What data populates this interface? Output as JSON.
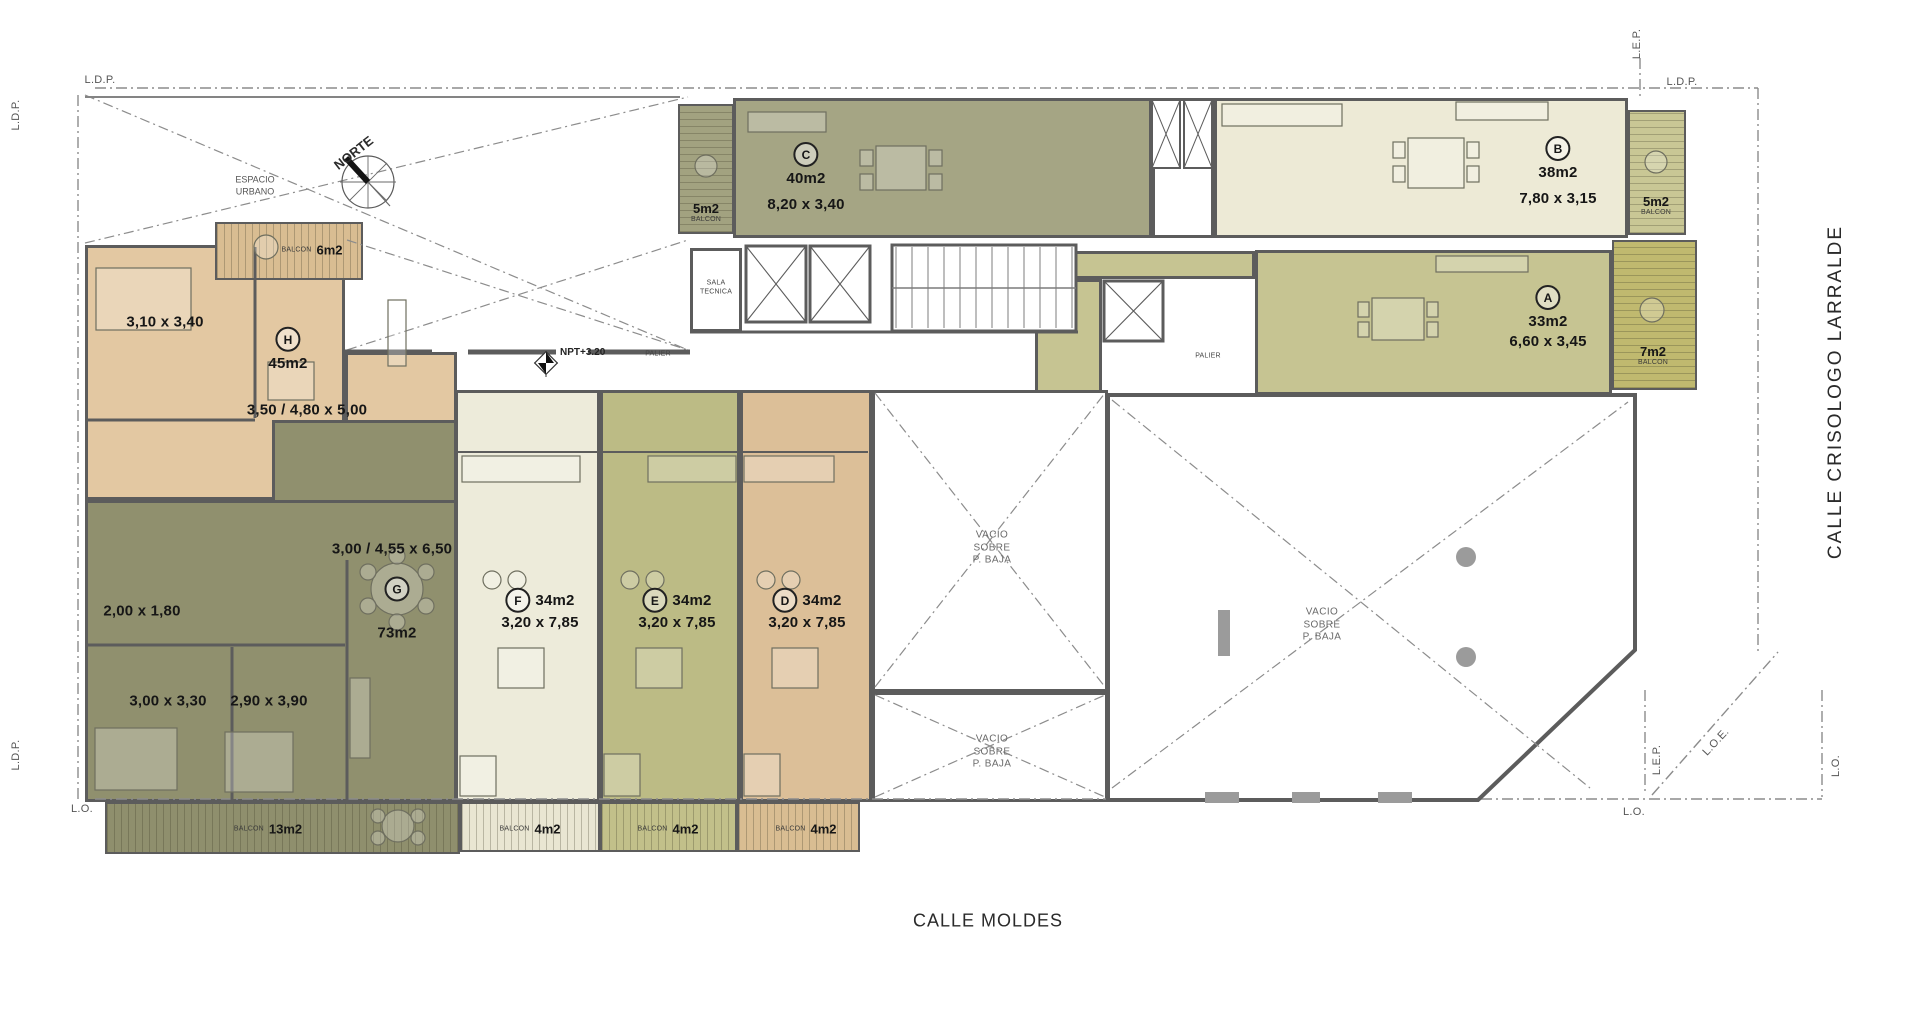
{
  "streets": {
    "bottom": "CALLE MOLDES",
    "right": "CALLE CRISOLOGO LARRALDE"
  },
  "core": {
    "norte": "NORTE",
    "espacio_urbano": [
      "ESPACIO",
      "URBANO"
    ],
    "npt": "NPT+3.20",
    "palier": "PALIER",
    "sala_tecnica": [
      "SALA",
      "TECNICA"
    ],
    "vacio": [
      "VACIO",
      "SOBRE",
      "P. BAJA"
    ]
  },
  "boundaries": {
    "ldp": "L.D.P.",
    "lep": "L.E.P.",
    "lo": "L.O.",
    "loe": "L.O.E."
  },
  "units": {
    "a": {
      "letter": "A",
      "area": "33m2",
      "dims": [
        "6,60 x 3,45"
      ]
    },
    "b": {
      "letter": "B",
      "area": "38m2",
      "dims": [
        "7,80 x 3,15"
      ]
    },
    "c": {
      "letter": "C",
      "area": "40m2",
      "dims": [
        "8,20 x 3,40"
      ]
    },
    "d": {
      "letter": "D",
      "area": "34m2",
      "dims": [
        "3,20 x 7,85"
      ]
    },
    "e": {
      "letter": "E",
      "area": "34m2",
      "dims": [
        "3,20 x 7,85"
      ]
    },
    "f": {
      "letter": "F",
      "area": "34m2",
      "dims": [
        "3,20 x 7,85"
      ]
    },
    "g": {
      "letter": "G",
      "area": "73m2",
      "dims": [
        "3,00 / 4,55 x 6,50",
        "2,00 x 1,80",
        "3,00 x 3,30",
        "2,90 x 3,90"
      ]
    },
    "h": {
      "letter": "H",
      "area": "45m2",
      "dims": [
        "3,10 x 3,40",
        "3,50 / 4,80 x 5,00"
      ]
    }
  },
  "balconies": {
    "c_side": {
      "label": "BALCON",
      "area": "5m2"
    },
    "h_front": {
      "label": "BALCON",
      "area": "6m2"
    },
    "b_side": {
      "label": "BALCON",
      "area": "5m2"
    },
    "a_side": {
      "label": "BALCON",
      "area": "7m2"
    },
    "g_front": {
      "label": "BALCON",
      "area": "13m2"
    },
    "f_front": {
      "label": "BALCON",
      "area": "4m2"
    },
    "e_front": {
      "label": "BALCON",
      "area": "4m2"
    },
    "d_front": {
      "label": "BALCON",
      "area": "4m2"
    }
  },
  "colors": {
    "wall": "#5c5c5c",
    "unit_a": "#c6c492",
    "unit_b": "#edead6",
    "unit_c": "#a5a584",
    "unit_d": "#dcbf98",
    "unit_e": "#bcbb85",
    "unit_f": "#edebda",
    "unit_g": "#90906e",
    "unit_h": "#e3c8a2",
    "balc_olive": "#a2a280",
    "balc_dark_olive": "#8f8f6d",
    "balc_tan": "#d9bd92",
    "balc_cream": "#e9e6d2",
    "balc_green": "#c2c08a",
    "balc_khaki": "#c9c795",
    "balc_dark_khaki": "#c0b96f"
  }
}
